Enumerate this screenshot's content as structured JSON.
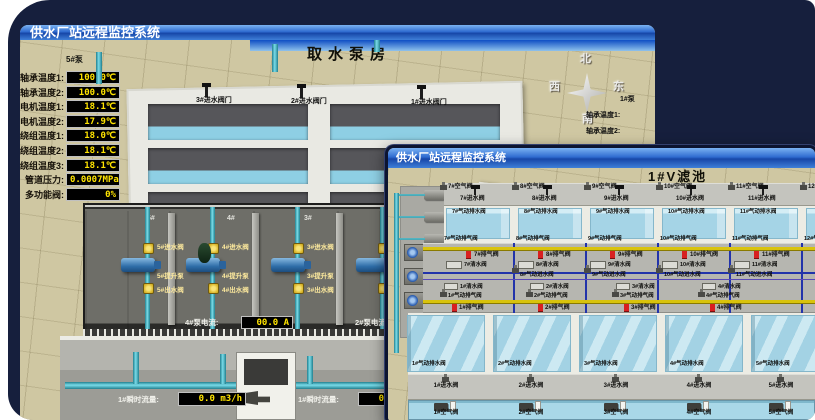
{
  "colors": {
    "canvas_bg": "#161f3d",
    "titlebar_blue": "#2f6bd0",
    "led_text": "#ffe400",
    "pipe_cyan": "#3fb6c9",
    "valve_yellow": "#e8c53a",
    "alarm_red": "#d82020",
    "water_blue": "#a5d4e6",
    "ground_tan": "#cfc7a2"
  },
  "back_window": {
    "title": "供水厂站远程监控系统",
    "scene_title": "取水泵房",
    "panel": {
      "title": "5#泵",
      "rows": [
        {
          "label": "轴承温度1:",
          "value": "100.0℃"
        },
        {
          "label": "轴承温度2:",
          "value": "100.0℃"
        },
        {
          "label": "电机温度1:",
          "value": "18.1℃"
        },
        {
          "label": "电机温度2:",
          "value": "17.9℃"
        },
        {
          "label": "绕组温度1:",
          "value": "18.0℃"
        },
        {
          "label": "绕组温度2:",
          "value": "18.1℃"
        },
        {
          "label": "绕组温度3:",
          "value": "18.1℃"
        },
        {
          "label": "管道压力:",
          "value": "0.0007MPa"
        },
        {
          "label": "多功能阀:",
          "value": "0%"
        }
      ]
    },
    "intake_valves": [
      "3#进水阀门",
      "2#进水阀门",
      "1#进水阀门"
    ],
    "pump_room": {
      "bay_ids": [
        "5#",
        "4#",
        "3#",
        "2#"
      ],
      "bays": [
        {
          "inlet": "5#进水阀",
          "pump": "5#提升泵",
          "outlet": "5#出水阀"
        },
        {
          "inlet": "4#进水阀",
          "pump": "4#提升泵",
          "outlet": "4#出水阀"
        },
        {
          "inlet": "3#进水阀",
          "pump": "3#提升泵",
          "outlet": "3#出水阀"
        },
        {
          "inlet": "2#进水阀",
          "pump": "2#提升泵",
          "outlet": "2#出水阀"
        }
      ],
      "current_readouts": [
        {
          "label": "4#泵电流:",
          "value": "00.0 A"
        },
        {
          "label": "2#泵电流:",
          "value": "00.0 A"
        }
      ]
    },
    "flow_readouts": [
      {
        "label": "1#瞬时流量:",
        "value": "0.0 m3/h"
      },
      {
        "label": "1#瞬时流量:",
        "value": "0.0 m3/h"
      }
    ],
    "compass": {
      "n": "北",
      "w": "西",
      "s": "南",
      "e": "东"
    },
    "side_labels": [
      "1#泵",
      "轴承温度1:",
      "轴承温度2:"
    ]
  },
  "front_window": {
    "title": "供水厂站远程监控系统",
    "scene_title": "1#V滤池",
    "pumps": [
      "1#水泵",
      "2#水泵",
      "3#水泵"
    ],
    "blowers": [
      "1#风机",
      "2#风机",
      "3#风机"
    ],
    "upper_cells": {
      "air": [
        "7#空气阀",
        "8#空气阀",
        "9#空气阀",
        "10#空气阀",
        "11#空气阀",
        "12#空气阀"
      ],
      "inlet": [
        "7#进水阀",
        "8#进水阀",
        "9#进水阀",
        "10#进水阀",
        "11#进水阀"
      ],
      "pneu_drain": [
        "7#气动排水阀",
        "8#气动排水阀",
        "9#气动排水阀",
        "10#气动排水阀",
        "11#气动排水阀"
      ],
      "pneu_exhaust": [
        "7#气动排气阀",
        "8#气动排气阀",
        "9#气动排气阀",
        "10#气动排气阀",
        "11#气动排气阀",
        "12#气动排气阀"
      ],
      "exhaust": [
        "7#排气阀",
        "8#排气阀",
        "9#排气阀",
        "10#排气阀",
        "11#排气阀"
      ],
      "clean": [
        "7#清水阀",
        "8#清水阀",
        "9#清水阀",
        "10#清水阀",
        "11#清水阀"
      ],
      "pneu_inlet": [
        "8#气动进水阀",
        "9#气动进水阀",
        "10#气动进水阀",
        "11#气动进水阀"
      ]
    },
    "lower_cells": {
      "clean": [
        "1#清水阀",
        "2#清水阀",
        "3#清水阀",
        "4#清水阀"
      ],
      "pneu_exhaust": [
        "1#气动排气阀",
        "2#气动排气阀",
        "3#气动排气阀",
        "4#气动排气阀"
      ],
      "exhaust": [
        "1#排气阀",
        "2#排气阀",
        "3#排气阀",
        "4#排气阀"
      ],
      "pneu_drain": [
        "1#气动排水阀",
        "2#气动排水阀",
        "3#气动排水阀",
        "4#气动排水阀",
        "5#气动排水阀"
      ],
      "inlet": [
        "1#进水阀",
        "2#进水阀",
        "3#进水阀",
        "4#进水阀",
        "5#进水阀"
      ],
      "air": [
        "1#空气阀",
        "2#空气阀",
        "3#空气阀",
        "4#空气阀",
        "5#空气阀"
      ]
    }
  }
}
